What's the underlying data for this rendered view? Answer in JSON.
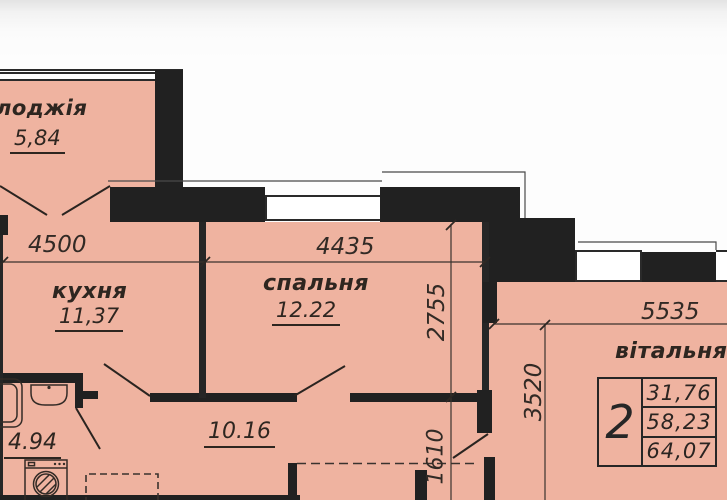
{
  "plan": {
    "rooms": {
      "loggia": {
        "label": "лоджія",
        "area": "5,84"
      },
      "kitchen": {
        "label": "кухня",
        "area": "11,37"
      },
      "bedroom": {
        "label": "спальня",
        "area": "12.22"
      },
      "living": {
        "label": "вітальня"
      },
      "bathroom": {
        "area": "4.94"
      },
      "hallway": {
        "area": "10.16"
      }
    },
    "dimensions": {
      "kitchen_width": "4500",
      "bedroom_width": "4435",
      "bedroom_depth": "2755",
      "living_width": "5535",
      "living_depth": "3520",
      "hall_depth": "1610"
    },
    "summary_table": {
      "rooms_count": "2",
      "living_area": "31,76",
      "dwelling_area": "58,23",
      "total_area": "64,07"
    },
    "colors": {
      "floor": "#efb3a0",
      "wall": "#212121"
    }
  }
}
